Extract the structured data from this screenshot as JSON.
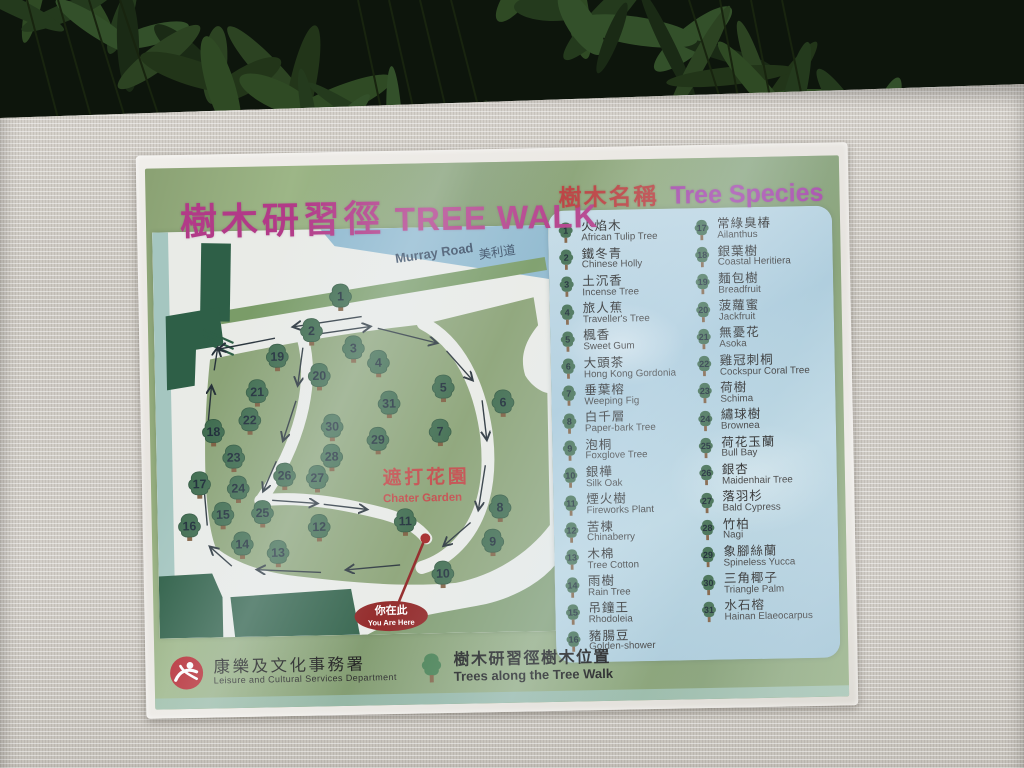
{
  "sign": {
    "title_zh": "樹木研習徑",
    "title_en": "TREE WALK",
    "species_header_zh": "樹木名稱",
    "species_header_en": "Tree Species"
  },
  "map": {
    "road_label_en": "Murray Road",
    "road_label_zh": "美利道",
    "garden_label_zh": "遮打花園",
    "garden_label_en": "Chater Garden",
    "you_are_here_zh": "你在此",
    "you_are_here_en": "You Are Here",
    "trees": [
      {
        "n": 1,
        "x": 189,
        "y": 67
      },
      {
        "n": 2,
        "x": 159,
        "y": 101
      },
      {
        "n": 3,
        "x": 201,
        "y": 119
      },
      {
        "n": 4,
        "x": 226,
        "y": 134
      },
      {
        "n": 5,
        "x": 291,
        "y": 160
      },
      {
        "n": 6,
        "x": 351,
        "y": 176
      },
      {
        "n": 7,
        "x": 287,
        "y": 204
      },
      {
        "n": 8,
        "x": 346,
        "y": 281
      },
      {
        "n": 9,
        "x": 338,
        "y": 315
      },
      {
        "n": 10,
        "x": 287,
        "y": 346
      },
      {
        "n": 11,
        "x": 250,
        "y": 293
      },
      {
        "n": 12,
        "x": 163,
        "y": 297
      },
      {
        "n": 13,
        "x": 121,
        "y": 322
      },
      {
        "n": 14,
        "x": 85,
        "y": 313
      },
      {
        "n": 15,
        "x": 66,
        "y": 283
      },
      {
        "n": 16,
        "x": 32,
        "y": 294
      },
      {
        "n": 17,
        "x": 43,
        "y": 252
      },
      {
        "n": 18,
        "x": 58,
        "y": 200
      },
      {
        "n": 19,
        "x": 124,
        "y": 126
      },
      {
        "n": 20,
        "x": 166,
        "y": 146
      },
      {
        "n": 21,
        "x": 103,
        "y": 161
      },
      {
        "n": 22,
        "x": 95,
        "y": 189
      },
      {
        "n": 23,
        "x": 78,
        "y": 226
      },
      {
        "n": 24,
        "x": 82,
        "y": 257
      },
      {
        "n": 25,
        "x": 106,
        "y": 282
      },
      {
        "n": 26,
        "x": 129,
        "y": 245
      },
      {
        "n": 27,
        "x": 162,
        "y": 248
      },
      {
        "n": 28,
        "x": 177,
        "y": 227
      },
      {
        "n": 29,
        "x": 224,
        "y": 211
      },
      {
        "n": 30,
        "x": 178,
        "y": 197
      },
      {
        "n": 31,
        "x": 236,
        "y": 175
      }
    ],
    "arrows": [
      [
        122,
        108,
        64,
        118
      ],
      [
        210,
        88,
        140,
        97
      ],
      [
        154,
        106,
        219,
        98
      ],
      [
        226,
        100,
        286,
        116
      ],
      [
        295,
        124,
        321,
        154
      ],
      [
        330,
        174,
        334,
        214
      ],
      [
        332,
        239,
        324,
        284
      ],
      [
        316,
        296,
        288,
        319
      ],
      [
        150,
        118,
        144,
        156
      ],
      [
        142,
        171,
        128,
        211
      ],
      [
        121,
        231,
        107,
        261
      ],
      [
        116,
        270,
        162,
        274
      ],
      [
        168,
        275,
        212,
        281
      ],
      [
        244,
        337,
        189,
        341
      ],
      [
        164,
        343,
        99,
        339
      ],
      [
        74,
        335,
        52,
        315
      ],
      [
        50,
        294,
        47,
        249
      ],
      [
        51,
        209,
        57,
        154
      ],
      [
        60,
        139,
        64,
        116
      ]
    ]
  },
  "species": {
    "left": [
      {
        "n": 1,
        "zh": "火焰木",
        "en": "African Tulip Tree"
      },
      {
        "n": 2,
        "zh": "鐵冬青",
        "en": "Chinese Holly"
      },
      {
        "n": 3,
        "zh": "土沉香",
        "en": "Incense Tree"
      },
      {
        "n": 4,
        "zh": "旅人蕉",
        "en": "Traveller's Tree"
      },
      {
        "n": 5,
        "zh": "楓香",
        "en": "Sweet Gum"
      },
      {
        "n": 6,
        "zh": "大頭茶",
        "en": "Hong Kong Gordonia"
      },
      {
        "n": 7,
        "zh": "垂葉榕",
        "en": "Weeping Fig"
      },
      {
        "n": 8,
        "zh": "白千層",
        "en": "Paper-bark Tree"
      },
      {
        "n": 9,
        "zh": "泡桐",
        "en": "Foxglove Tree"
      },
      {
        "n": 10,
        "zh": "銀樺",
        "en": "Silk Oak"
      },
      {
        "n": 11,
        "zh": "煙火樹",
        "en": "Fireworks Plant"
      },
      {
        "n": 12,
        "zh": "苦楝",
        "en": "Chinaberry"
      },
      {
        "n": 13,
        "zh": "木棉",
        "en": "Tree Cotton"
      },
      {
        "n": 14,
        "zh": "雨樹",
        "en": "Rain Tree"
      },
      {
        "n": 15,
        "zh": "吊鐘王",
        "en": "Rhodoleia"
      },
      {
        "n": 16,
        "zh": "豬腸豆",
        "en": "Golden-shower"
      }
    ],
    "right": [
      {
        "n": 17,
        "zh": "常綠臭椿",
        "en": "Ailanthus"
      },
      {
        "n": 18,
        "zh": "銀葉樹",
        "en": "Coastal Heritiera"
      },
      {
        "n": 19,
        "zh": "麵包樹",
        "en": "Breadfruit"
      },
      {
        "n": 20,
        "zh": "菠蘿蜜",
        "en": "Jackfruit"
      },
      {
        "n": 21,
        "zh": "無憂花",
        "en": "Asoka"
      },
      {
        "n": 22,
        "zh": "雞冠刺桐",
        "en": "Cockspur Coral Tree"
      },
      {
        "n": 23,
        "zh": "荷樹",
        "en": "Schima"
      },
      {
        "n": 24,
        "zh": "繡球樹",
        "en": "Brownea"
      },
      {
        "n": 25,
        "zh": "荷花玉蘭",
        "en": "Bull Bay"
      },
      {
        "n": 26,
        "zh": "銀杏",
        "en": "Maidenhair Tree"
      },
      {
        "n": 27,
        "zh": "落羽杉",
        "en": "Bald Cypress"
      },
      {
        "n": 28,
        "zh": "竹柏",
        "en": "Nagi"
      },
      {
        "n": 29,
        "zh": "象腳絲蘭",
        "en": "Spineless Yucca"
      },
      {
        "n": 30,
        "zh": "三角椰子",
        "en": "Triangle Palm"
      },
      {
        "n": 31,
        "zh": "水石榕",
        "en": "Hainan Elaeocarpus"
      }
    ]
  },
  "legend": {
    "dept_zh": "康樂及文化事務署",
    "dept_en": "Leisure and Cultural Services Department",
    "walk_zh": "樹木研習徑樹木位置",
    "walk_en": "Trees along the Tree Walk"
  },
  "colors": {
    "title_magenta": "#b23a88",
    "header_red": "#b93a3a",
    "header_purple": "#a23ca5",
    "lawn_green": "#8ba377",
    "dark_green": "#2e5f47",
    "road_blue": "#8fb9cf",
    "path_white": "#e9ebe7",
    "you_are_here_red": "#8e2020",
    "logo_red": "#b5242c"
  }
}
